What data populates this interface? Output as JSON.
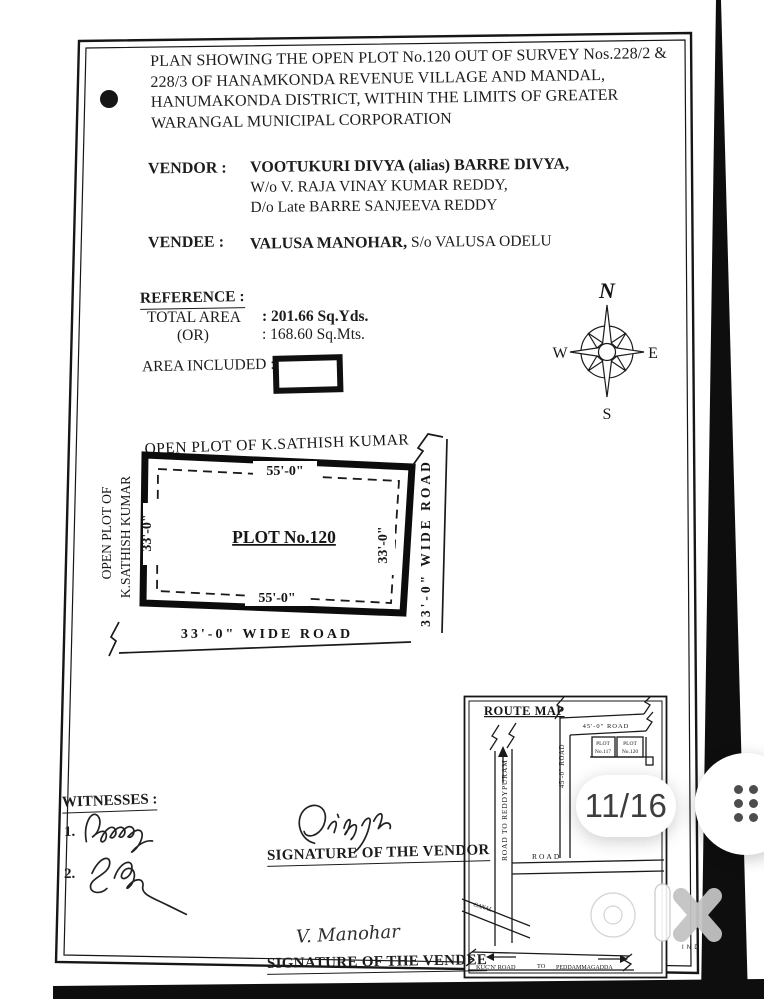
{
  "document": {
    "title_lines": [
      "PLAN SHOWING THE OPEN PLOT No.120 OUT OF SURVEY Nos.228/2 &",
      "228/3 OF HANAMKONDA REVENUE VILLAGE AND MANDAL,",
      "HANUMAKONDA DISTRICT, WITHIN THE LIMITS OF GREATER",
      "WARANGAL MUNICIPAL CORPORATION"
    ],
    "vendor_label": "VENDOR :",
    "vendor_name": "VOOTUKURI DIVYA (alias) BARRE DIVYA,",
    "vendor_line2": "W/o  V. RAJA VINAY KUMAR REDDY,",
    "vendor_line3": "D/o  Late BARRE SANJEEVA REDDY",
    "vendee_label": "VENDEE  :",
    "vendee_name": "VALUSA MANOHAR,",
    "vendee_rest": "  S/o  VALUSA ODELU",
    "reference_heading": "REFERENCE :",
    "total_area_label": "TOTAL AREA",
    "total_area_value": ": 201.66  Sq.Yds.",
    "or_label": "(OR)",
    "or_value": ": 168.60  Sq.Mts.",
    "area_included_label": "AREA INCLUDED :",
    "compass": {
      "north": "N",
      "south": "S",
      "east": "E",
      "west": "W"
    },
    "plot": {
      "neighbor_top": "OPEN PLOT OF K.SATHISH KUMAR",
      "neighbor_left_line1": "OPEN PLOT OF",
      "neighbor_left_line2": "K.SATHISH KUMAR",
      "dim_top": "55'-0\"",
      "dim_bottom": "55'-0\"",
      "dim_left": "33'-0\"",
      "dim_right": "33'-0\"",
      "plot_name": "PLOT No.120",
      "road_right": "33'-0\" WIDE ROAD",
      "road_bottom": "33'-0\"  WIDE  ROAD"
    },
    "route_map": {
      "title": "ROUTE MAP",
      "road_reddypuram": "ROAD TO REDDYPURAM",
      "road_45_vertical": "45'-0\" ROAD",
      "road_45_horizontal": "45'-0\" ROAD",
      "box1_line1": "PLOT",
      "box1_line2": "No.117",
      "box2_line1": "PLOT",
      "box2_line2": "No.120",
      "road_mid": "ROAD",
      "canal": "CANAL",
      "bottom_left": "KUC'N' ROAD",
      "bottom_mid": "TO",
      "bottom_right": "PEDDAMMAGADDA"
    },
    "witnesses_heading": "WITNESSES :",
    "witness1_no": "1.",
    "witness2_no": "2.",
    "vendor_sign_caption": "SIGNATURE OF THE VENDOR",
    "vendee_sign_caption": "SIGNATURE OF THE VENDEE",
    "vendee_sign_name": "V. Manohar"
  },
  "overlay": {
    "page_indicator": "11/16",
    "watermark_country": "INDIA"
  }
}
